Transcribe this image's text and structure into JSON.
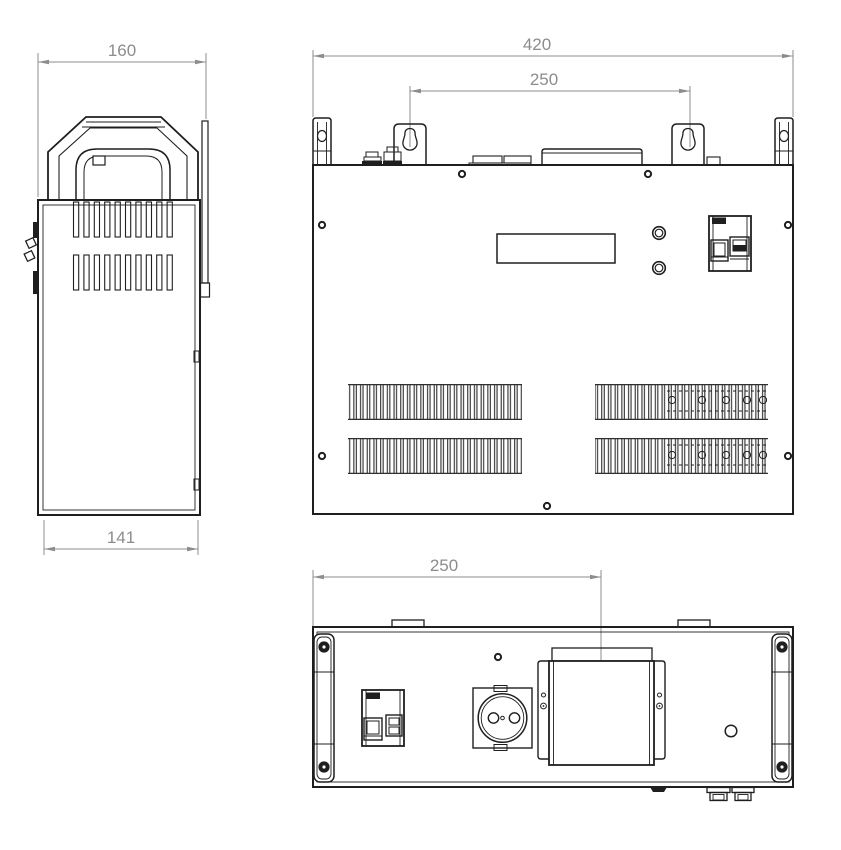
{
  "dimensions": {
    "side_top_width_mm": "160",
    "side_depth_mm": "141",
    "front_width_mm": "420",
    "front_mount_spacing_mm": "250",
    "bottom_mount_offset_mm": "250"
  },
  "colors": {
    "object_line": "#1f1f1f",
    "dimension_line": "#8c8c8c",
    "background": "#ffffff"
  }
}
